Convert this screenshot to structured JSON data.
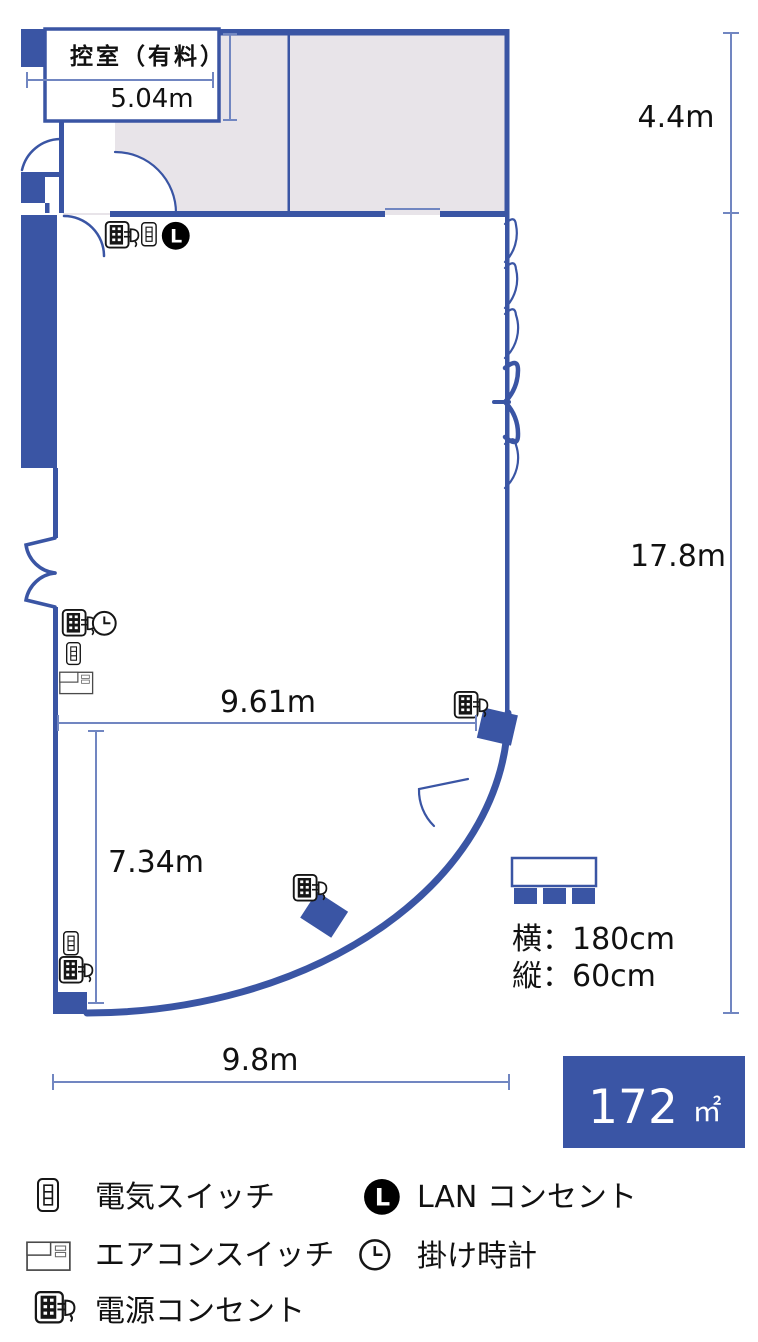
{
  "plan": {
    "room_label": "控室（有料）",
    "dims": {
      "hikae_width": "5.04m",
      "upper_right": "4.4m",
      "right": "17.8m",
      "middle_width": "9.61m",
      "lower_left": "7.34m",
      "bottom": "9.8m"
    },
    "table": {
      "width": "横：180cm",
      "depth": "縦：60cm"
    },
    "area": {
      "value": "172",
      "unit": "㎡"
    }
  },
  "legend": {
    "items": [
      {
        "id": "light-switch",
        "label": "電気スイッチ"
      },
      {
        "id": "aircon-switch",
        "label": "エアコンスイッチ"
      },
      {
        "id": "power-outlet",
        "label": "電源コンセント"
      },
      {
        "id": "lan-outlet",
        "label": "LAN コンセント"
      },
      {
        "id": "wall-clock",
        "label": "掛け時計"
      }
    ]
  },
  "colors": {
    "wall": "#3a55a4",
    "dim": "#7186c1",
    "gray": "#e8e4e9",
    "badge": "#3a55a5",
    "ink": "#111111"
  }
}
